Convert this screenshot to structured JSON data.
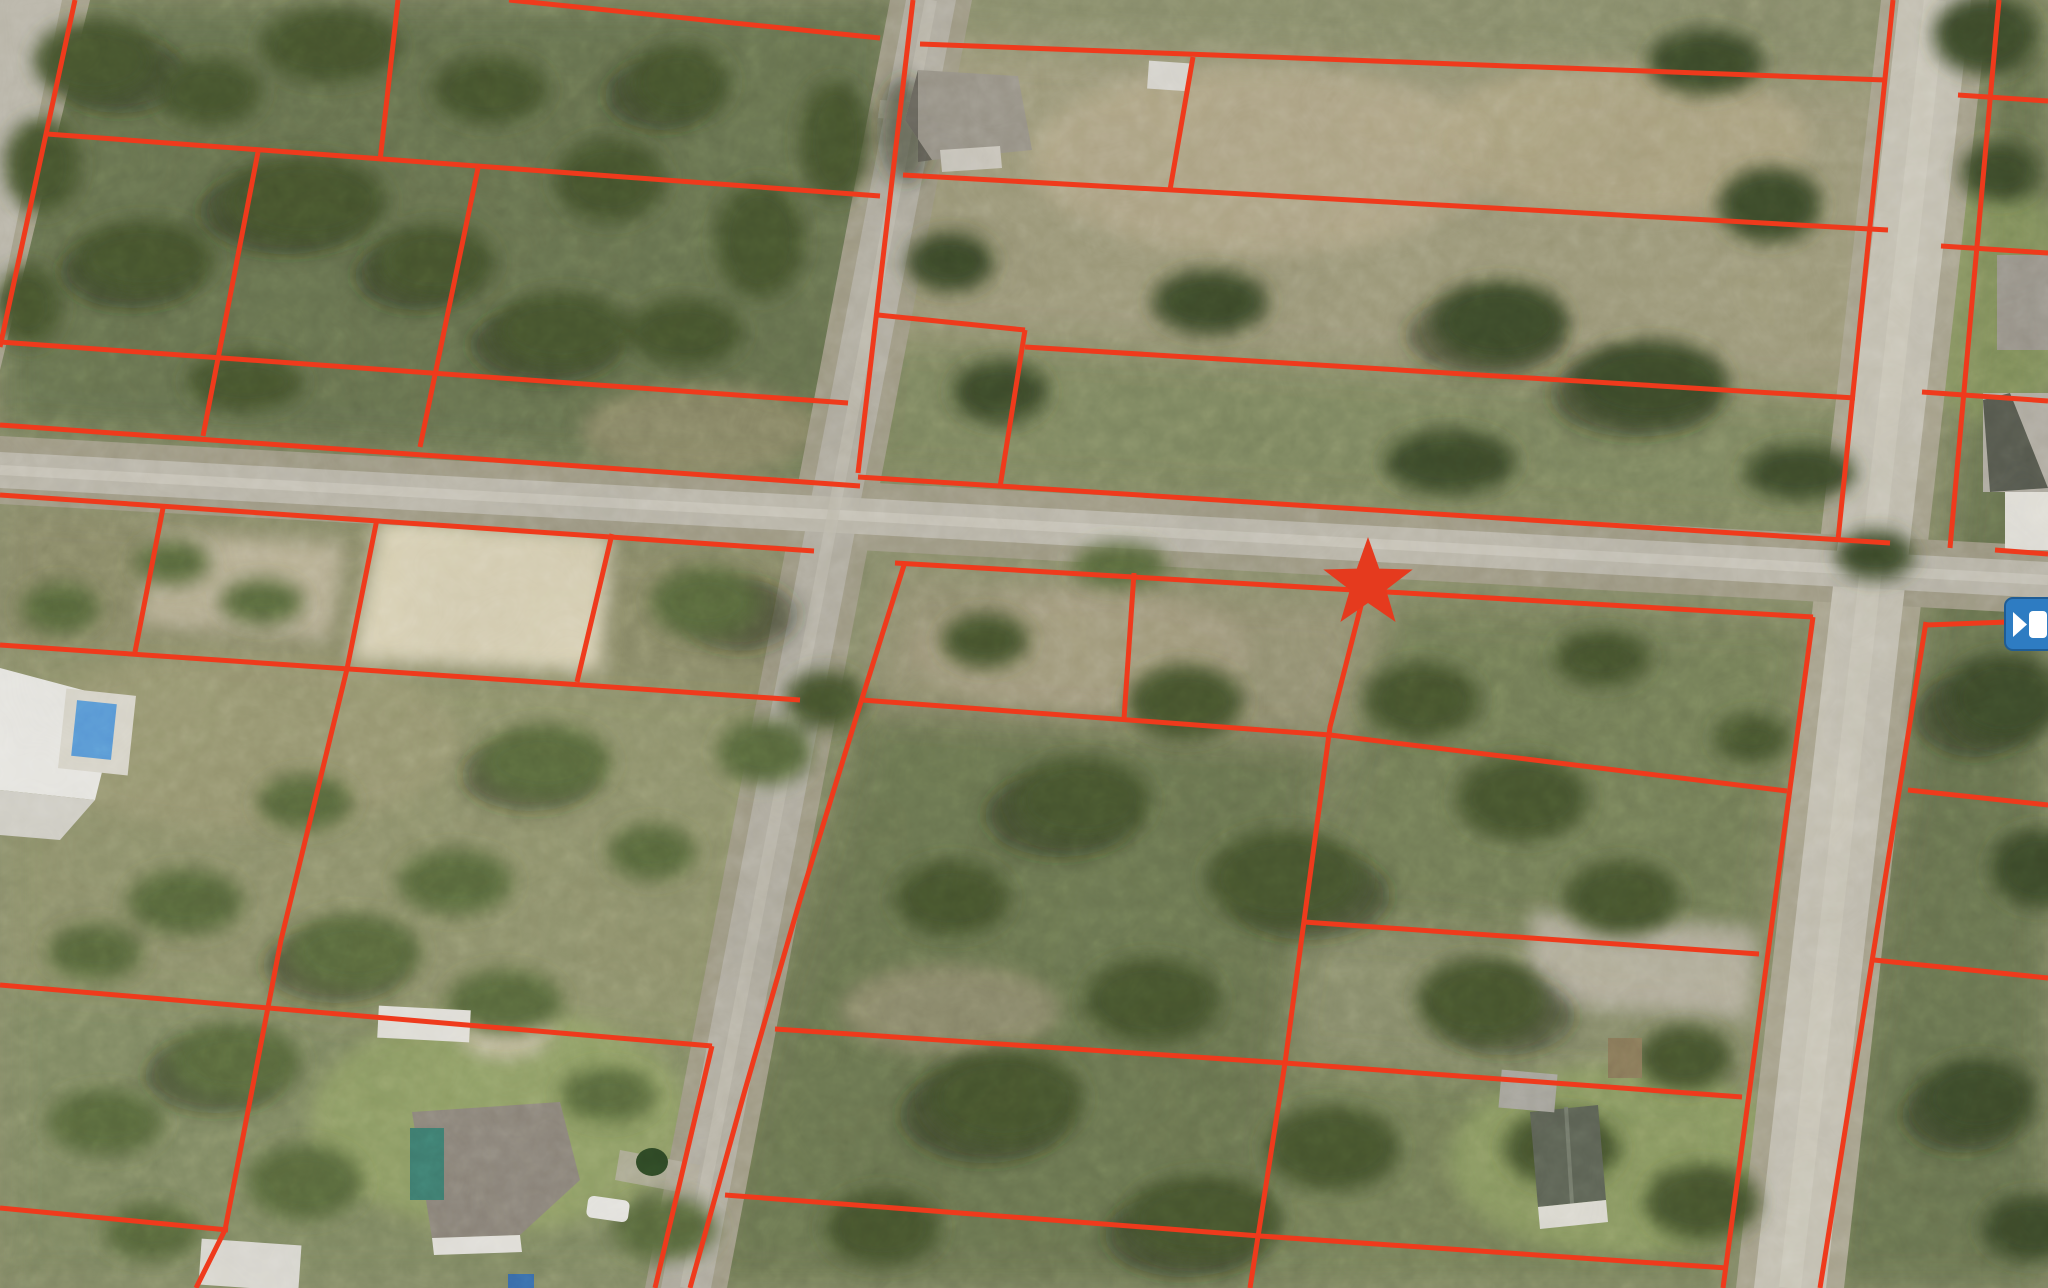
{
  "view": {
    "type": "aerial-parcel-map",
    "width": 2048,
    "height": 1288,
    "visible_text": "none",
    "description": "Oblique aerial photo of a semi-rural subdivision (vacant wooded lots, a few houses) with a red parcel-boundary overlay, a red star marker on the subject parcel corner, and a blue video/camera button clipped at the right edge."
  },
  "colors": {
    "parcel_line_red": "#ef3a1c",
    "star_red": "#e53a1e",
    "video_button_blue": "#2e7cc2",
    "video_button_glyph": "#ffffff",
    "road_pavement": "#bcb8ab",
    "road_shoulder": "#a19c86",
    "terrain_base": "#8b8f6d",
    "tree_canopy": "#47552f",
    "sand": "#d9d1b5",
    "lawn": "#93a368",
    "pool_water": "#5a9bd8",
    "pool_screen_teal": "#3f7f72"
  },
  "marker": {
    "name": "star-marker",
    "shape": "five-point-star",
    "fill": "#e53a1e",
    "cx": 1368,
    "cy": 584,
    "outer_radius": 47,
    "location": "on parcel line south of the horizontal street, center-right of view"
  },
  "video_button": {
    "name": "video-button",
    "fill": "#2e7cc2",
    "glyph": "video-camera (play triangle + filled square)",
    "glyph_color": "#ffffff",
    "x": 2005,
    "y": 598,
    "width": 50,
    "height": 52,
    "clipped_by_right_edge": true
  },
  "roads": [
    {
      "name": "horizontal-street",
      "from": [
        0,
        470
      ],
      "to": [
        2048,
        580
      ],
      "pavement_width": 38
    },
    {
      "name": "left-vertical-street",
      "from": [
        931,
        0
      ],
      "to": [
        686,
        1288
      ],
      "pavement_width": 50
    },
    {
      "name": "right-vertical-street",
      "from": [
        1935,
        0
      ],
      "to": [
        1790,
        1288
      ],
      "pavement_width": 72
    },
    {
      "name": "corner-street-top-left",
      "from": [
        40,
        0
      ],
      "to": [
        0,
        330
      ],
      "pavement_width": 55
    }
  ],
  "parcel_lines": [
    [
      [
        75,
        0
      ],
      [
        0,
        347
      ]
    ],
    [
      [
        509,
        0
      ],
      [
        880,
        38
      ]
    ],
    [
      [
        47,
        134
      ],
      [
        880,
        196
      ]
    ],
    [
      [
        0,
        342
      ],
      [
        848,
        403
      ]
    ],
    [
      [
        0,
        425
      ],
      [
        860,
        486
      ]
    ],
    [
      [
        0,
        495
      ],
      [
        814,
        551
      ]
    ],
    [
      [
        0,
        645
      ],
      [
        800,
        700
      ]
    ],
    [
      [
        0,
        985
      ],
      [
        712,
        1046
      ]
    ],
    [
      [
        0,
        1208
      ],
      [
        228,
        1230
      ]
    ],
    [
      [
        398,
        0
      ],
      [
        380,
        161
      ]
    ],
    [
      [
        258,
        152
      ],
      [
        203,
        436
      ]
    ],
    [
      [
        478,
        168
      ],
      [
        420,
        447
      ]
    ],
    [
      [
        163,
        508
      ],
      [
        135,
        652
      ]
    ],
    [
      [
        377,
        519
      ],
      [
        347,
        669
      ],
      [
        281,
        940
      ],
      [
        225,
        1230
      ],
      [
        196,
        1288
      ]
    ],
    [
      [
        612,
        534
      ],
      [
        577,
        682
      ]
    ],
    [
      [
        712,
        1046
      ],
      [
        655,
        1288
      ]
    ],
    [
      [
        913,
        0
      ],
      [
        858,
        473
      ]
    ],
    [
      [
        920,
        44
      ],
      [
        1885,
        80
      ]
    ],
    [
      [
        903,
        175
      ],
      [
        1888,
        230
      ]
    ],
    [
      [
        1193,
        57
      ],
      [
        1170,
        190
      ]
    ],
    [
      [
        878,
        315
      ],
      [
        1025,
        330
      ]
    ],
    [
      [
        1025,
        330
      ],
      [
        1000,
        487
      ]
    ],
    [
      [
        1025,
        347
      ],
      [
        1855,
        398
      ]
    ],
    [
      [
        858,
        477
      ],
      [
        1890,
        543
      ]
    ],
    [
      [
        1995,
        550
      ],
      [
        2048,
        554
      ]
    ],
    [
      [
        895,
        563
      ],
      [
        1813,
        617
      ]
    ],
    [
      [
        905,
        562
      ],
      [
        860,
        705
      ],
      [
        800,
        900
      ],
      [
        745,
        1090
      ],
      [
        690,
        1288
      ]
    ],
    [
      [
        1365,
        590
      ],
      [
        1330,
        727
      ],
      [
        1285,
        1063
      ],
      [
        1250,
        1288
      ]
    ],
    [
      [
        1134,
        573
      ],
      [
        1124,
        719
      ]
    ],
    [
      [
        862,
        700
      ],
      [
        1330,
        735
      ],
      [
        1787,
        791
      ]
    ],
    [
      [
        1304,
        922
      ],
      [
        1759,
        954
      ]
    ],
    [
      [
        775,
        1029
      ],
      [
        1285,
        1063
      ],
      [
        1742,
        1097
      ]
    ],
    [
      [
        725,
        1195
      ],
      [
        1260,
        1236
      ],
      [
        1727,
        1268
      ]
    ],
    [
      [
        1893,
        0
      ],
      [
        1838,
        540
      ]
    ],
    [
      [
        1813,
        617
      ],
      [
        1723,
        1288
      ]
    ],
    [
      [
        1999,
        0
      ],
      [
        1950,
        548
      ]
    ],
    [
      [
        1926,
        622
      ],
      [
        1820,
        1288
      ]
    ],
    [
      [
        1926,
        625
      ],
      [
        2008,
        622
      ]
    ],
    [
      [
        1958,
        95
      ],
      [
        2048,
        101
      ]
    ],
    [
      [
        1941,
        246
      ],
      [
        2048,
        253
      ]
    ],
    [
      [
        1922,
        392
      ],
      [
        2048,
        401
      ]
    ],
    [
      [
        1908,
        790
      ],
      [
        2048,
        805
      ]
    ],
    [
      [
        1874,
        960
      ],
      [
        2048,
        978
      ]
    ]
  ],
  "buildings": [
    {
      "name": "house-top-center",
      "roof": "#999488",
      "at": [
        935,
        60
      ]
    },
    {
      "name": "shed-top-center",
      "roof": "#d8d6cf",
      "at": [
        1150,
        64
      ]
    },
    {
      "name": "house-left-white-with-pool",
      "roof": "#e9e8e3",
      "pool": "#5a9bd8",
      "at": [
        0,
        665
      ]
    },
    {
      "name": "house-bottom-left",
      "roof": "#8d867b",
      "pool_screen": "#3f7f72",
      "at": [
        410,
        1105
      ]
    },
    {
      "name": "shed-bottom-left-white",
      "roof": "#e6e4dd",
      "at": [
        378,
        1008
      ]
    },
    {
      "name": "building-bottom-edge-white",
      "roof": "#dcdad2",
      "at": [
        200,
        1240
      ]
    },
    {
      "name": "house-bottom-right",
      "roof": "#5e6456",
      "at": [
        1528,
        1105
      ]
    },
    {
      "name": "shed-bottom-right-brown",
      "roof": "#8a7a5a",
      "at": [
        1608,
        1038
      ]
    },
    {
      "name": "house-top-right-edge",
      "roof": "#9b968c",
      "at": [
        1997,
        255
      ]
    },
    {
      "name": "warehouse-right-edge",
      "roof": "#b0aca1",
      "at": [
        1983,
        393
      ]
    },
    {
      "name": "structure-right-edge-white",
      "roof": "#e4e2da",
      "at": [
        2005,
        492
      ]
    },
    {
      "name": "car-white-bottom-left",
      "color": "#e8e7e2",
      "at": [
        587,
        1198
      ]
    }
  ]
}
